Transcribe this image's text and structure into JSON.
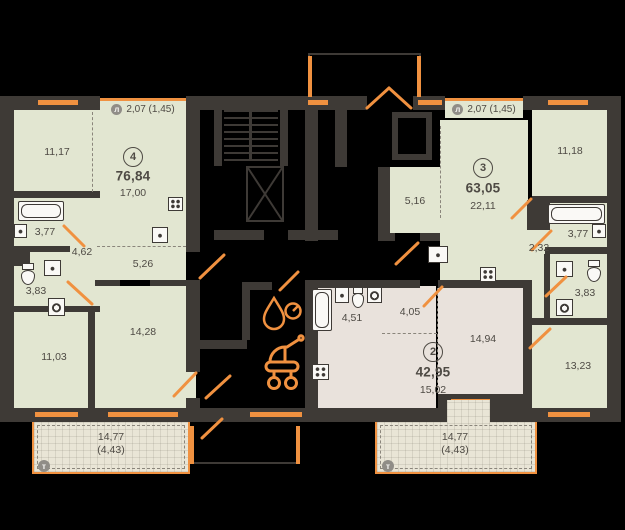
{
  "apartments": {
    "apt4": {
      "badge": "4",
      "total": "76,84",
      "areas": {
        "room1": "11,17",
        "kitchen_living": "17,00",
        "bath": "3,77",
        "hall": "4,62",
        "wc": "3,83",
        "corridor": "5,26",
        "room2": "14,28",
        "room3": "11,03"
      },
      "loggia": "2,07 (1,45)",
      "terrace_area": "14,77",
      "terrace_inner": "(4,43)"
    },
    "apt2": {
      "badge": "2",
      "total": "42,95",
      "areas": {
        "bath": "4,51",
        "hall": "4,05",
        "room": "15,02",
        "room2": "14,94"
      }
    },
    "apt3": {
      "badge": "3",
      "total": "63,05",
      "areas": {
        "hall": "5,16",
        "kitchen_living": "22,11",
        "room1": "11,18",
        "bath": "3,77",
        "hall2": "2,32",
        "wc": "3,83",
        "room2": "13,23"
      },
      "loggia": "2,07 (1,45)",
      "terrace_area": "14,77",
      "terrace_inner": "(4,43)"
    }
  },
  "symbols": {
    "loggia_letter": "л",
    "terrace_letter": "т"
  },
  "colors": {
    "accent": "#f09140",
    "apartment_fill": "#e2e6d1",
    "studio_fill": "#e9e2dc",
    "terrace_fill": "#e9e5d6",
    "wall": "#3e3a36",
    "background": "#000000"
  }
}
